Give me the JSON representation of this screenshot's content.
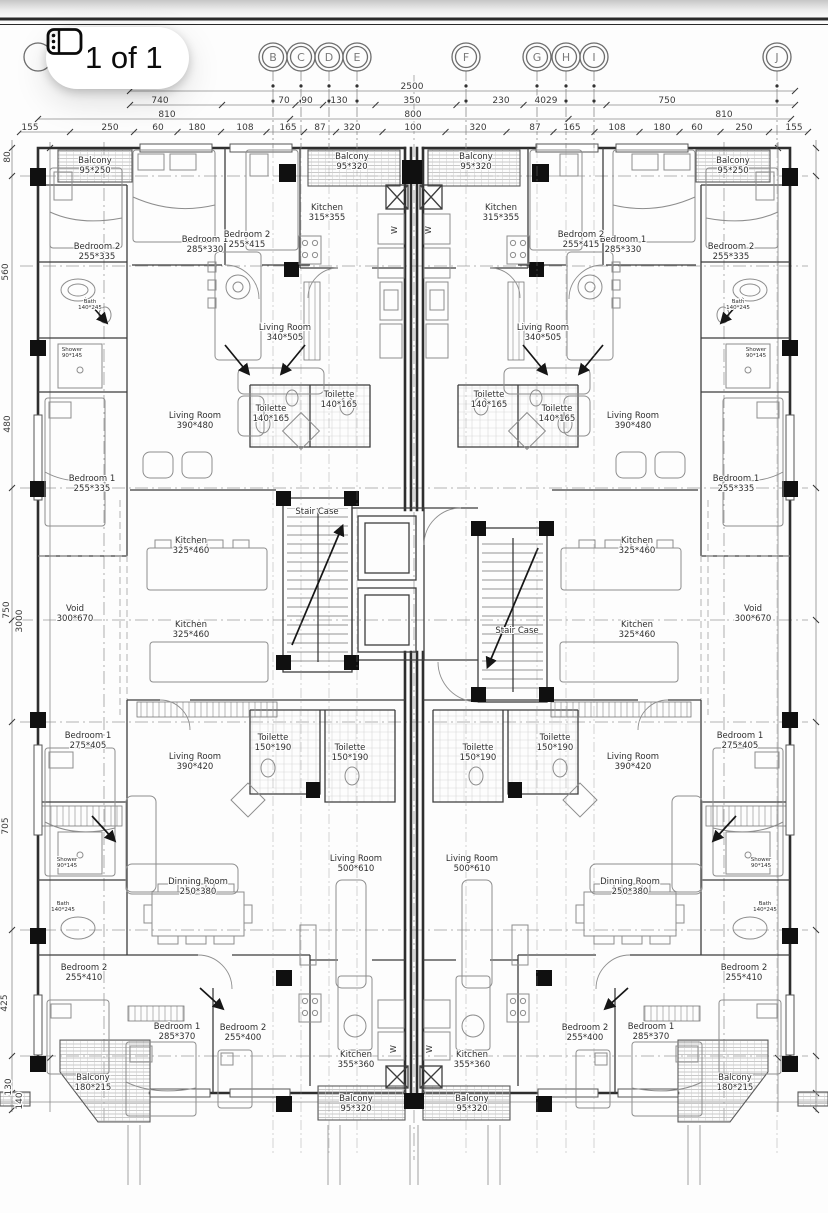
{
  "badge": {
    "label": "1 of 1",
    "icon": "pages-icon"
  },
  "grid_bubbles": [
    {
      "letter": "B",
      "x": 273
    },
    {
      "letter": "C",
      "x": 301
    },
    {
      "letter": "D",
      "x": 329
    },
    {
      "letter": "E",
      "x": 357
    },
    {
      "letter": "F",
      "x": 466
    },
    {
      "letter": "G",
      "x": 537
    },
    {
      "letter": "H",
      "x": 566
    },
    {
      "letter": "I",
      "x": 594
    },
    {
      "letter": "J",
      "x": 777
    }
  ],
  "dimensions": {
    "rows": [
      {
        "y": 91,
        "x0": 130,
        "x1": 795,
        "labels": [
          {
            "v": "2500",
            "x": 412
          }
        ]
      },
      {
        "y": 105,
        "x0": 130,
        "x1": 795,
        "labels": [
          {
            "v": "740",
            "x": 160
          },
          {
            "v": "70",
            "x": 284
          },
          {
            "v": "90",
            "x": 307
          },
          {
            "v": "130",
            "x": 339
          },
          {
            "v": "350",
            "x": 412
          },
          {
            "v": "230",
            "x": 501
          },
          {
            "v": "4029",
            "x": 546
          },
          {
            "v": "750",
            "x": 667
          }
        ]
      },
      {
        "y": 119,
        "x0": 38,
        "x1": 791,
        "labels": [
          {
            "v": "810",
            "x": 167
          },
          {
            "v": "800",
            "x": 413
          },
          {
            "v": "810",
            "x": 724
          }
        ]
      },
      {
        "y": 132,
        "x0": 20,
        "x1": 808,
        "labels": [
          {
            "v": "155",
            "x": 30
          },
          {
            "v": "250",
            "x": 110
          },
          {
            "v": "60",
            "x": 158
          },
          {
            "v": "180",
            "x": 197
          },
          {
            "v": "108",
            "x": 245
          },
          {
            "v": "165",
            "x": 288
          },
          {
            "v": "87",
            "x": 320
          },
          {
            "v": "320",
            "x": 352
          },
          {
            "v": "100",
            "x": 413
          },
          {
            "v": "320",
            "x": 478
          },
          {
            "v": "87",
            "x": 535
          },
          {
            "v": "165",
            "x": 572
          },
          {
            "v": "108",
            "x": 617
          },
          {
            "v": "180",
            "x": 662
          },
          {
            "v": "60",
            "x": 697
          },
          {
            "v": "250",
            "x": 744
          },
          {
            "v": "155",
            "x": 794
          }
        ]
      }
    ],
    "left": [
      {
        "v": "80",
        "x": 10,
        "y": 157
      },
      {
        "v": "560",
        "x": 8,
        "y": 272
      },
      {
        "v": "480",
        "x": 10,
        "y": 424
      },
      {
        "v": "750",
        "x": 9,
        "y": 610
      },
      {
        "v": "3000",
        "x": 22,
        "y": 621
      },
      {
        "v": "705",
        "x": 8,
        "y": 826
      },
      {
        "v": "425",
        "x": 7,
        "y": 1003
      },
      {
        "v": "130",
        "x": 11,
        "y": 1087
      },
      {
        "v": "140",
        "x": 22,
        "y": 1101
      }
    ]
  },
  "rooms": [
    {
      "name": "Balcony",
      "size": "95*250",
      "x": 95,
      "y": 163
    },
    {
      "name": "Bedroom 2",
      "size": "255*335",
      "x": 97,
      "y": 249
    },
    {
      "name": "Bedroom 1",
      "size": "285*330",
      "x": 205,
      "y": 242
    },
    {
      "name": "Bedroom 2",
      "size": "255*415",
      "x": 247,
      "y": 237
    },
    {
      "name": "Kitchen",
      "size": "315*355",
      "x": 327,
      "y": 210
    },
    {
      "name": "Balcony",
      "size": "95*320",
      "x": 352,
      "y": 159
    },
    {
      "name": "Living Room",
      "size": "340*505",
      "x": 285,
      "y": 330
    },
    {
      "name": "Bath",
      "size": "140*245",
      "x": 90,
      "y": 303,
      "small": true
    },
    {
      "name": "Shower",
      "size": "90*145",
      "x": 72,
      "y": 351,
      "small": true
    },
    {
      "name": "Living Room",
      "size": "390*480",
      "x": 195,
      "y": 418
    },
    {
      "name": "Toilette",
      "size": "140*165",
      "x": 271,
      "y": 411
    },
    {
      "name": "Toilette",
      "size": "140*165",
      "x": 339,
      "y": 397
    },
    {
      "name": "Bedroom 1",
      "size": "255*335",
      "x": 92,
      "y": 481
    },
    {
      "name": "Stair Case",
      "size": "",
      "x": 317,
      "y": 514
    },
    {
      "name": "Kitchen",
      "size": "325*460",
      "x": 191,
      "y": 543
    },
    {
      "name": "Kitchen",
      "size": "325*460",
      "x": 191,
      "y": 627
    },
    {
      "name": "Void",
      "size": "300*670",
      "x": 75,
      "y": 611
    },
    {
      "name": "Bedroom 1",
      "size": "275*405",
      "x": 88,
      "y": 738
    },
    {
      "name": "Living Room",
      "size": "390*420",
      "x": 195,
      "y": 759
    },
    {
      "name": "Toilette",
      "size": "150*190",
      "x": 273,
      "y": 740
    },
    {
      "name": "Toilette",
      "size": "150*190",
      "x": 350,
      "y": 750
    },
    {
      "name": "Living Room",
      "size": "500*610",
      "x": 356,
      "y": 861
    },
    {
      "name": "Dinning Room",
      "size": "250*380",
      "x": 198,
      "y": 884
    },
    {
      "name": "Shower",
      "size": "90*145",
      "x": 67,
      "y": 861,
      "small": true
    },
    {
      "name": "Bath",
      "size": "140*245",
      "x": 63,
      "y": 905,
      "small": true
    },
    {
      "name": "Bedroom 2",
      "size": "255*410",
      "x": 84,
      "y": 970
    },
    {
      "name": "Bedroom 1",
      "size": "285*370",
      "x": 177,
      "y": 1029
    },
    {
      "name": "Bedroom 2",
      "size": "255*400",
      "x": 243,
      "y": 1030
    },
    {
      "name": "Kitchen",
      "size": "355*360",
      "x": 356,
      "y": 1057
    },
    {
      "name": "Balcony",
      "size": "95*320",
      "x": 356,
      "y": 1101
    },
    {
      "name": "Balcony",
      "size": "180*215",
      "x": 93,
      "y": 1080
    },
    {
      "name": "Balcony",
      "size": "95*250",
      "x": 733,
      "y": 163
    },
    {
      "name": "Bedroom 2",
      "size": "255*335",
      "x": 731,
      "y": 249
    },
    {
      "name": "Bedroom 1",
      "size": "285*330",
      "x": 623,
      "y": 242
    },
    {
      "name": "Bedroom 2",
      "size": "255*415",
      "x": 581,
      "y": 237
    },
    {
      "name": "Kitchen",
      "size": "315*355",
      "x": 501,
      "y": 210
    },
    {
      "name": "Balcony",
      "size": "95*320",
      "x": 476,
      "y": 159
    },
    {
      "name": "Living Room",
      "size": "340*505",
      "x": 543,
      "y": 330
    },
    {
      "name": "Bath",
      "size": "140*245",
      "x": 738,
      "y": 303,
      "small": true
    },
    {
      "name": "Shower",
      "size": "90*145",
      "x": 756,
      "y": 351,
      "small": true
    },
    {
      "name": "Living Room",
      "size": "390*480",
      "x": 633,
      "y": 418
    },
    {
      "name": "Toilette",
      "size": "140*165",
      "x": 557,
      "y": 411
    },
    {
      "name": "Toilette",
      "size": "140*165",
      "x": 489,
      "y": 397
    },
    {
      "name": "Bedroom 1",
      "size": "255*335",
      "x": 736,
      "y": 481
    },
    {
      "name": "Stair Case",
      "size": "",
      "x": 517,
      "y": 633
    },
    {
      "name": "Kitchen",
      "size": "325*460",
      "x": 637,
      "y": 543
    },
    {
      "name": "Kitchen",
      "size": "325*460",
      "x": 637,
      "y": 627
    },
    {
      "name": "Void",
      "size": "300*670",
      "x": 753,
      "y": 611
    },
    {
      "name": "Bedroom 1",
      "size": "275*405",
      "x": 740,
      "y": 738
    },
    {
      "name": "Living Room",
      "size": "390*420",
      "x": 633,
      "y": 759
    },
    {
      "name": "Toilette",
      "size": "150*190",
      "x": 555,
      "y": 740
    },
    {
      "name": "Toilette",
      "size": "150*190",
      "x": 478,
      "y": 750
    },
    {
      "name": "Living Room",
      "size": "500*610",
      "x": 472,
      "y": 861
    },
    {
      "name": "Dinning Room",
      "size": "250*380",
      "x": 630,
      "y": 884
    },
    {
      "name": "Shower",
      "size": "90*145",
      "x": 761,
      "y": 861,
      "small": true
    },
    {
      "name": "Bath",
      "size": "140*245",
      "x": 765,
      "y": 905,
      "small": true
    },
    {
      "name": "Bedroom 2",
      "size": "255*410",
      "x": 744,
      "y": 970
    },
    {
      "name": "Bedroom 1",
      "size": "285*370",
      "x": 651,
      "y": 1029
    },
    {
      "name": "Bedroom 2",
      "size": "255*400",
      "x": 585,
      "y": 1030
    },
    {
      "name": "Kitchen",
      "size": "355*360",
      "x": 472,
      "y": 1057
    },
    {
      "name": "Balcony",
      "size": "95*320",
      "x": 472,
      "y": 1101
    },
    {
      "name": "Balcony",
      "size": "180*215",
      "x": 735,
      "y": 1080
    }
  ],
  "appliances": [
    {
      "v": "W",
      "x": 397,
      "y": 230
    },
    {
      "v": "W",
      "x": 431,
      "y": 230
    },
    {
      "v": "W",
      "x": 396,
      "y": 1049
    },
    {
      "v": "W",
      "x": 432,
      "y": 1049
    }
  ],
  "colors": {
    "paper": "#fdfdfd",
    "line_dark": "#2e2e2e",
    "line_mid": "#555555",
    "line_light": "#9a9a9a",
    "badge_bg": "#ffffff",
    "badge_text": "#0b0b0b"
  }
}
